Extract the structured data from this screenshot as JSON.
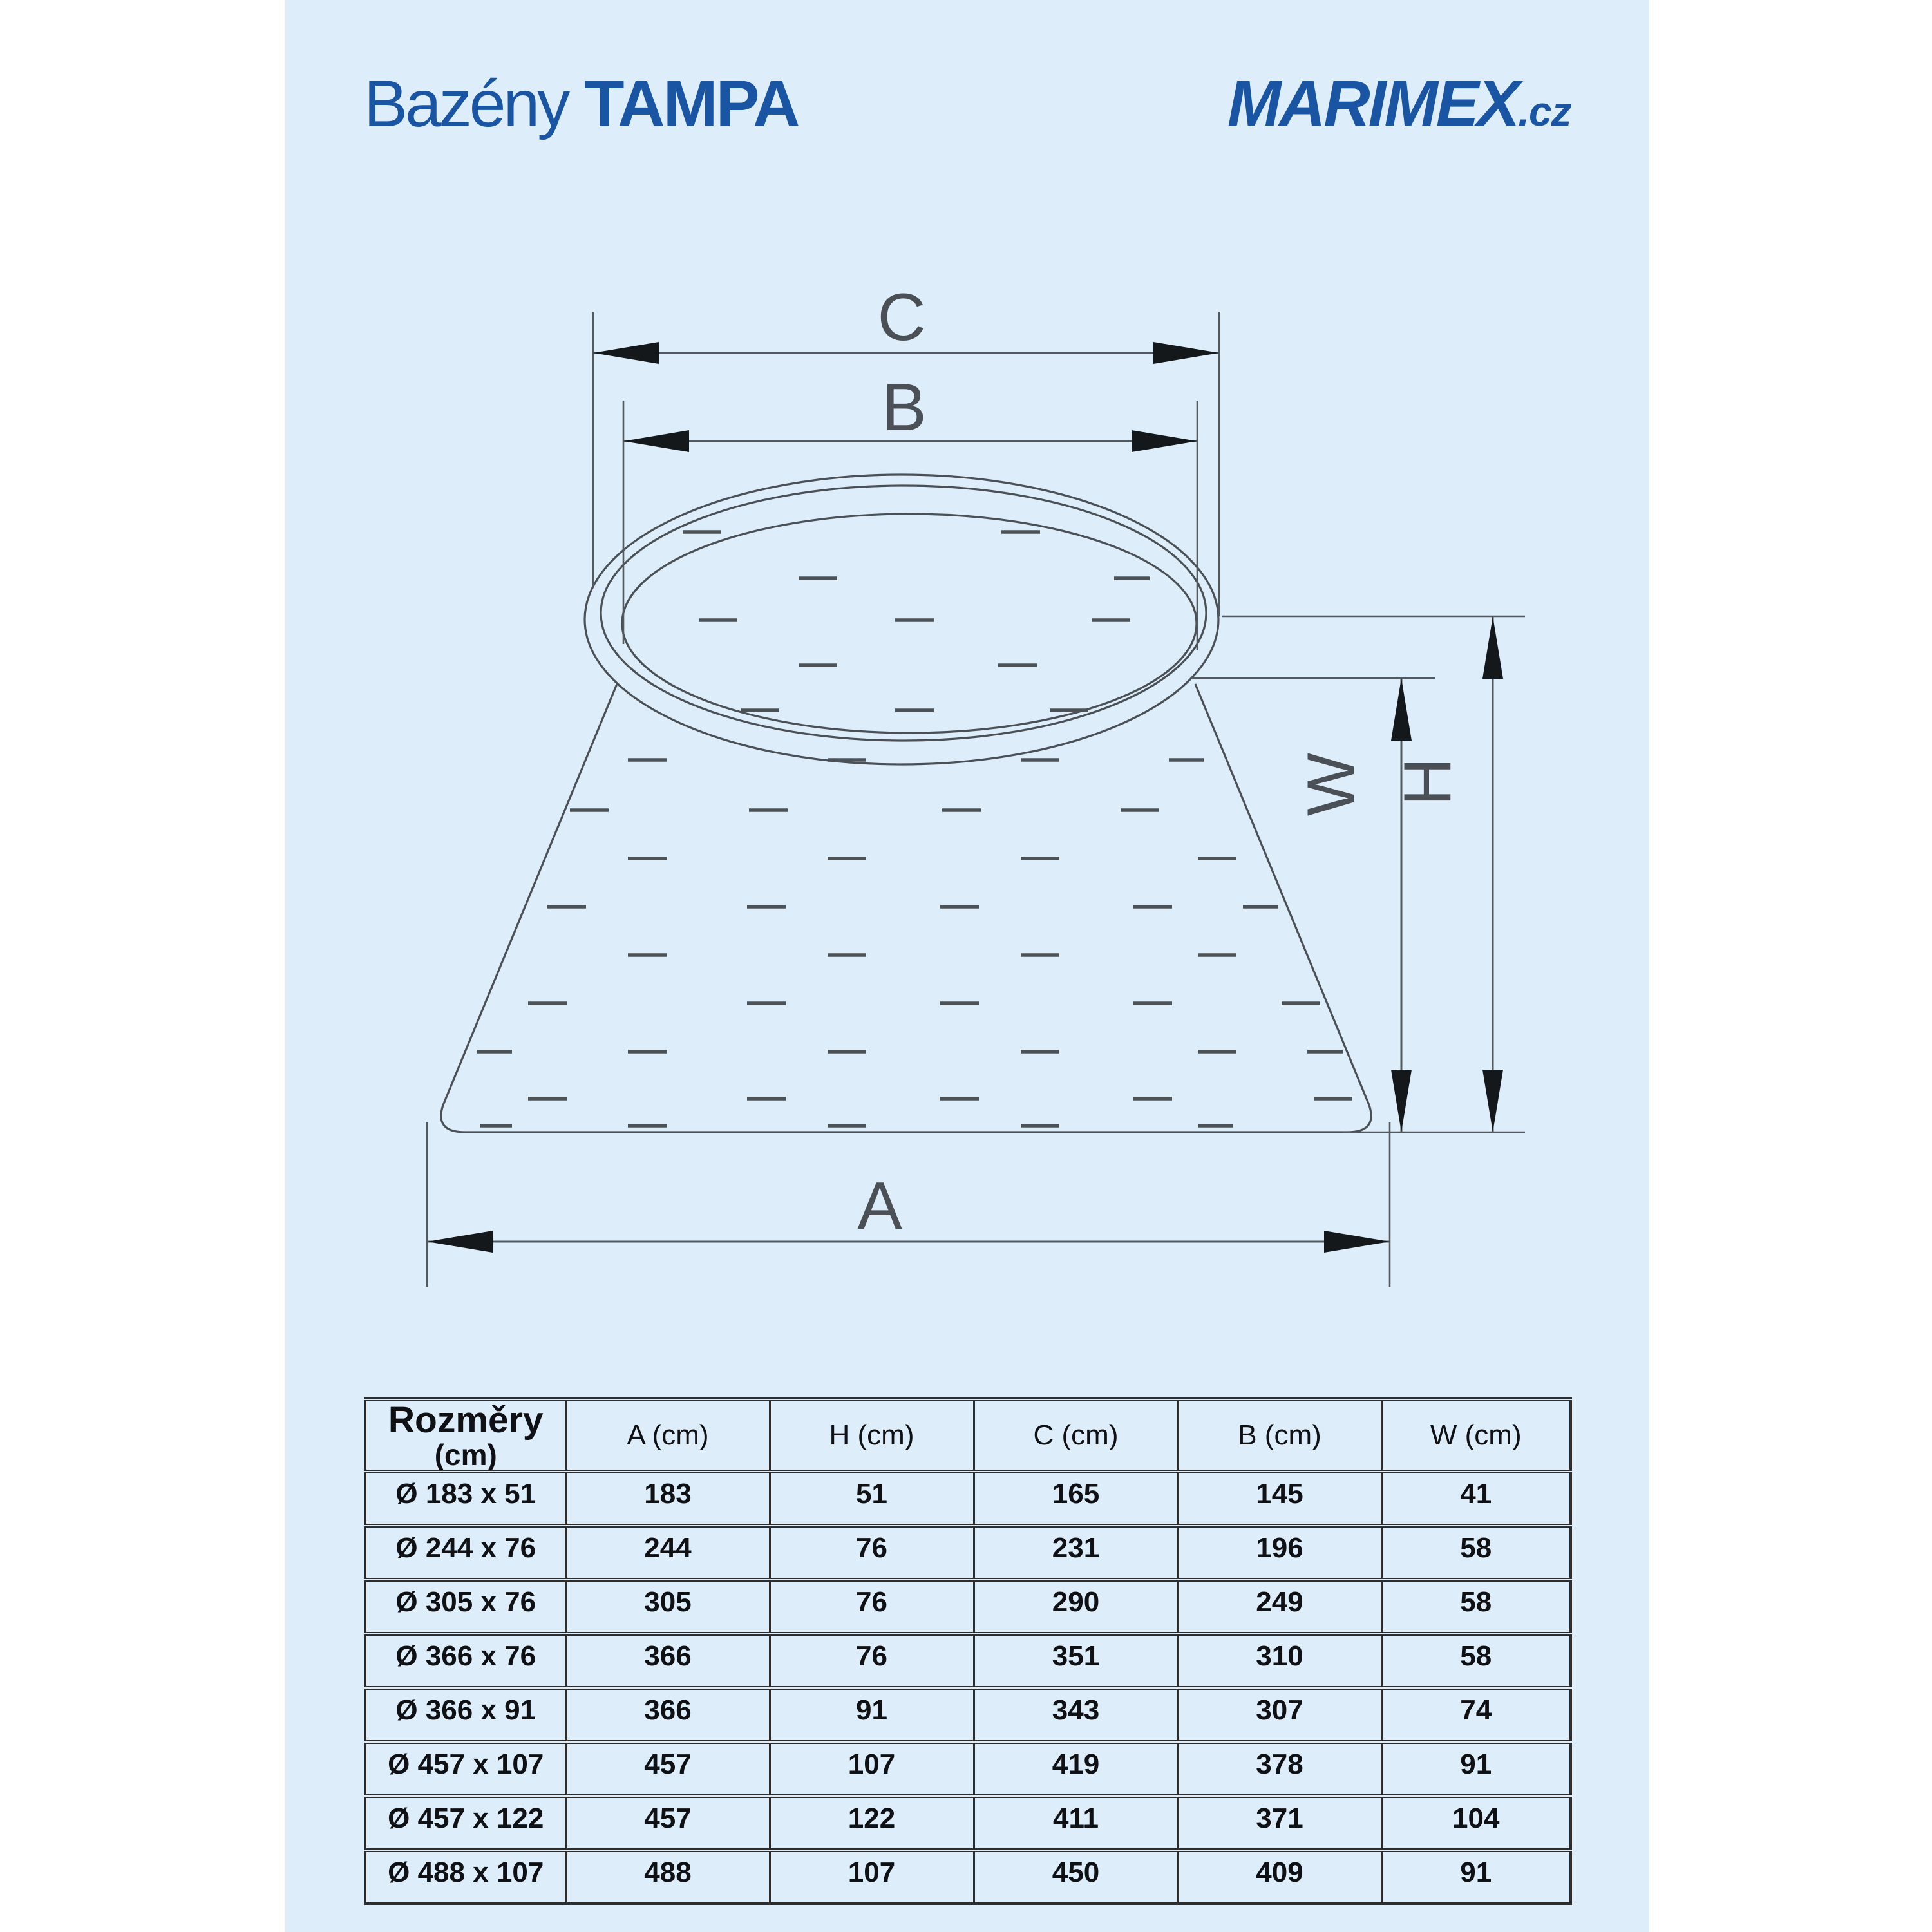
{
  "header": {
    "logo_left_prefix": "Bazény",
    "logo_left_brand": "TAMPA",
    "logo_right_brand": "MARIMEX",
    "logo_right_suffix": ".cz"
  },
  "diagram": {
    "label_c": "C",
    "label_b": "B",
    "label_a": "A",
    "label_h": "H",
    "label_w": "W"
  },
  "table": {
    "row_header_title": "Rozměry",
    "row_header_unit": "(cm)",
    "columns": [
      "A (cm)",
      "H (cm)",
      "C (cm)",
      "B (cm)",
      "W (cm)"
    ],
    "rows": [
      {
        "size": "Ø 183 x 51",
        "a": "183",
        "h": "51",
        "c": "165",
        "b": "145",
        "w": "41"
      },
      {
        "size": "Ø 244 x 76",
        "a": "244",
        "h": "76",
        "c": "231",
        "b": "196",
        "w": "58"
      },
      {
        "size": "Ø 305 x 76",
        "a": "305",
        "h": "76",
        "c": "290",
        "b": "249",
        "w": "58"
      },
      {
        "size": "Ø 366 x 76",
        "a": "366",
        "h": "76",
        "c": "351",
        "b": "310",
        "w": "58"
      },
      {
        "size": "Ø 366 x 91",
        "a": "366",
        "h": "91",
        "c": "343",
        "b": "307",
        "w": "74"
      },
      {
        "size": "Ø 457 x 107",
        "a": "457",
        "h": "107",
        "c": "419",
        "b": "378",
        "w": "91"
      },
      {
        "size": "Ø 457 x 122",
        "a": "457",
        "h": "122",
        "c": "411",
        "b": "371",
        "w": "104"
      },
      {
        "size": "Ø 488 x 107",
        "a": "488",
        "h": "107",
        "c": "450",
        "b": "409",
        "w": "91"
      }
    ]
  },
  "colors": {
    "page_background": "#ddeefa",
    "logo_blue": "#1a55a4",
    "drawing_line": "#4a5056",
    "arrow_black": "#15181b",
    "table_border": "#2d2d2d",
    "text_black": "#101114"
  }
}
